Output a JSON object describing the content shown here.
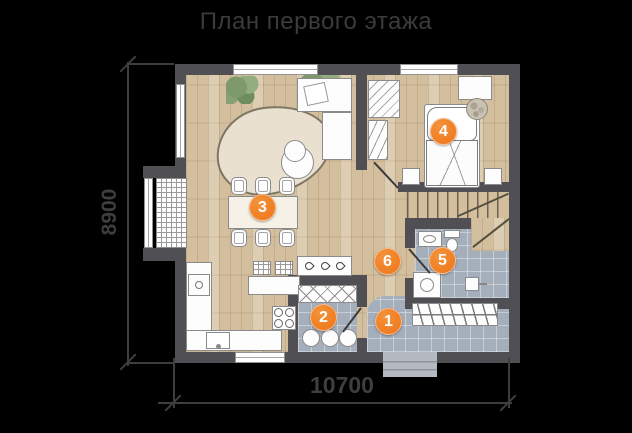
{
  "title": "План первого этажа",
  "dimensions": {
    "height_label": "8900",
    "width_label": "10700"
  },
  "markers": [
    {
      "number": "1"
    },
    {
      "number": "2"
    },
    {
      "number": "3"
    },
    {
      "number": "4"
    },
    {
      "number": "5"
    },
    {
      "number": "6"
    }
  ],
  "colors": {
    "background": "#000000",
    "title_text": "#3b3b3b",
    "wall": "#505054",
    "wood_floor": "#d3bf9e",
    "tile_floor": "#a5aebb",
    "rug": "#e9e0cf",
    "marker_orange": "#ed7418",
    "dimension_line": "#3e3e3e",
    "porch": "#b5b9c1",
    "plant_green": "#8ba37a"
  }
}
